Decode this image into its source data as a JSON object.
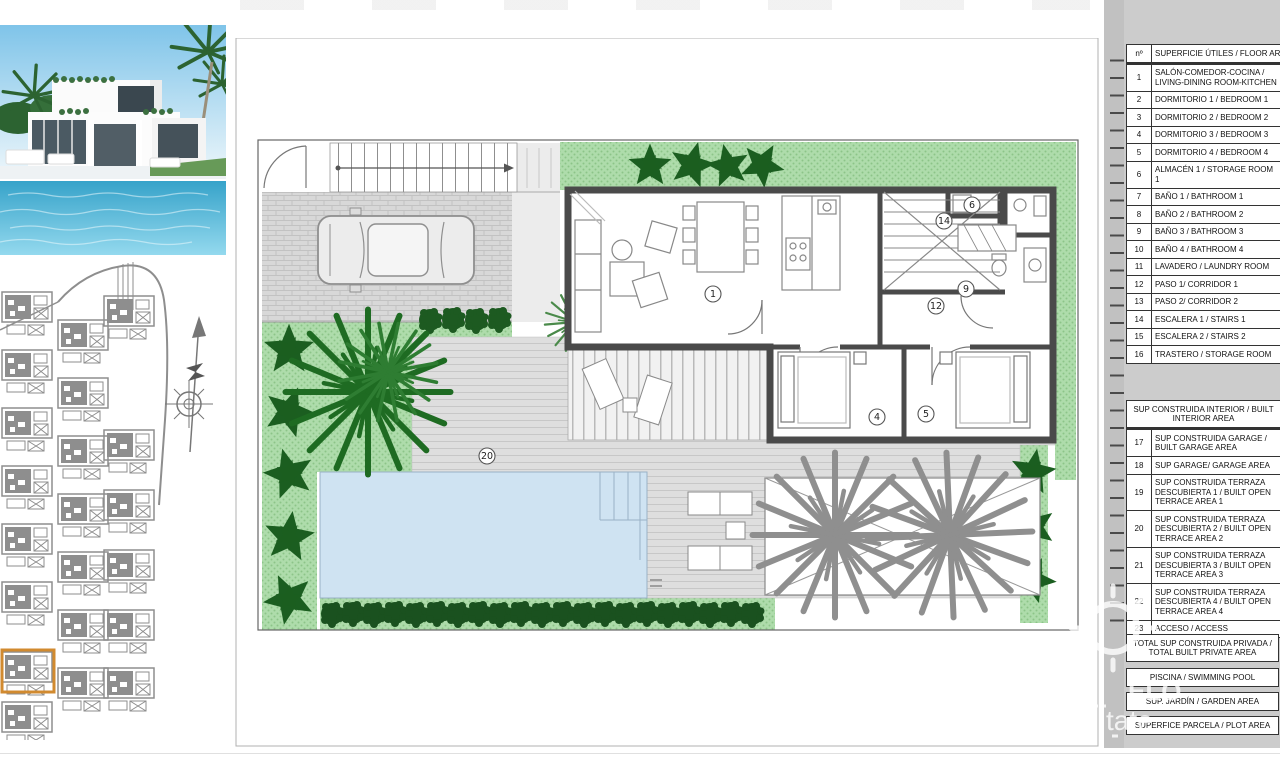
{
  "floor_table": {
    "number_header": "nº",
    "title": "SUPERFICIE ÚTILES / FLOOR AREA",
    "rows": [
      {
        "num": "1",
        "label": "SALÓN-COMEDOR-COCINA / LIVING-DINING ROOM-KITCHEN"
      },
      {
        "num": "2",
        "label": "DORMITORIO 1 / BEDROOM 1"
      },
      {
        "num": "3",
        "label": "DORMITORIO 2 / BEDROOM 2"
      },
      {
        "num": "4",
        "label": "DORMITORIO 3 / BEDROOM 3"
      },
      {
        "num": "5",
        "label": "DORMITORIO 4 / BEDROOM 4"
      },
      {
        "num": "6",
        "label": "ALMACÉN 1 / STORAGE ROOM 1"
      },
      {
        "num": "7",
        "label": "BAÑO 1 / BATHROOM 1"
      },
      {
        "num": "8",
        "label": "BAÑO 2 / BATHROOM 2"
      },
      {
        "num": "9",
        "label": "BAÑO 3 / BATHROOM 3"
      },
      {
        "num": "10",
        "label": "BAÑO 4 / BATHROOM 4"
      },
      {
        "num": "11",
        "label": "LAVADERO / LAUNDRY ROOM"
      },
      {
        "num": "12",
        "label": "PASO 1/ CORRIDOR 1"
      },
      {
        "num": "13",
        "label": "PASO 2/ CORRIDOR 2"
      },
      {
        "num": "14",
        "label": "ESCALERA 1 / STAIRS 1"
      },
      {
        "num": "15",
        "label": "ESCALERA 2 / STAIRS 2"
      },
      {
        "num": "16",
        "label": "TRASTERO / STORAGE ROOM"
      }
    ]
  },
  "built_table": {
    "title": "SUP CONSTRUIDA INTERIOR / BUILT INTERIOR AREA",
    "rows": [
      {
        "num": "17",
        "label": "SUP CONSTRUIDA GARAGE / BUILT GARAGE AREA"
      },
      {
        "num": "18",
        "label": "SUP GARAGE/ GARAGE AREA"
      },
      {
        "num": "19",
        "label": "SUP CONSTRUIDA TERRAZA DESCUBIERTA 1 / BUILT OPEN TERRACE AREA 1"
      },
      {
        "num": "20",
        "label": "SUP CONSTRUIDA TERRAZA DESCUBIERTA 2 / BUILT OPEN TERRACE AREA 2"
      },
      {
        "num": "21",
        "label": "SUP CONSTRUIDA TERRAZA DESCUBIERTA 3 / BUILT OPEN TERRACE AREA 3"
      },
      {
        "num": "22",
        "label": "SUP CONSTRUIDA TERRAZA DESCUBIERTA 4 / BUILT OPEN TERRACE AREA 4"
      },
      {
        "num": "23",
        "label": "ACCESO / ACCESS"
      }
    ]
  },
  "summary": {
    "total": "TOTAL SUP CONSTRUIDA PRIVADA / TOTAL BUILT PRIVATE AREA",
    "pool": "PISCINA / SWIMMING POOL",
    "garden": "SUP. JARDÍN / GARDEN AREA",
    "plot": "SUPERFICE PARCELA / PLOT AREA"
  },
  "plan": {
    "room_labels": [
      "1",
      "4",
      "5",
      "6",
      "9",
      "12",
      "14",
      "20"
    ]
  },
  "watermark": {
    "fragment1": "ELO",
    "fragment2": "tate"
  },
  "colors": {
    "garden_green": "#aedcab",
    "tree_dark": "#1b5e20",
    "pool_blue": "#cfe3f2",
    "deck_gray": "#dedede",
    "wall_gray": "#4a4a4a",
    "site_gray": "#8e8e8e",
    "highlight_orange": "#d18a2f",
    "panel_gray": "#cccccc"
  }
}
